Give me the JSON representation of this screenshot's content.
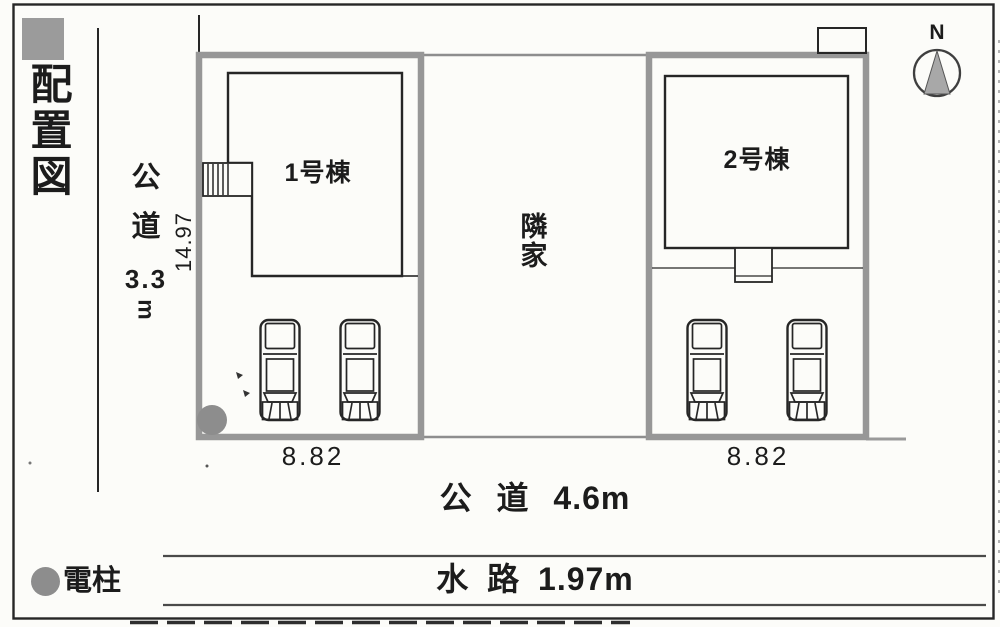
{
  "title": "配置図",
  "compass": {
    "north_label": "N"
  },
  "west_road": {
    "kanji": [
      "公",
      "道"
    ],
    "width_value": "3.3",
    "unit": "m"
  },
  "south_road": {
    "label": "公 道 4.6m"
  },
  "waterway": {
    "label": "水 路 1.97m"
  },
  "neighbor_house": {
    "kanji": [
      "隣",
      "家"
    ]
  },
  "legend": {
    "utility_pole_label": "電柱"
  },
  "buildings": [
    {
      "label": "1号棟",
      "frontage": "8.82",
      "parking_cars": 2
    },
    {
      "label": "2号棟",
      "frontage": "8.82",
      "parking_cars": 2
    }
  ],
  "dimensions": {
    "west_boundary_length": "14.97"
  },
  "colors": {
    "boundary_gray": "#979797",
    "line_black": "#262626",
    "marker_gray": "#8d8d8d",
    "paper": "#fcfcf9"
  }
}
